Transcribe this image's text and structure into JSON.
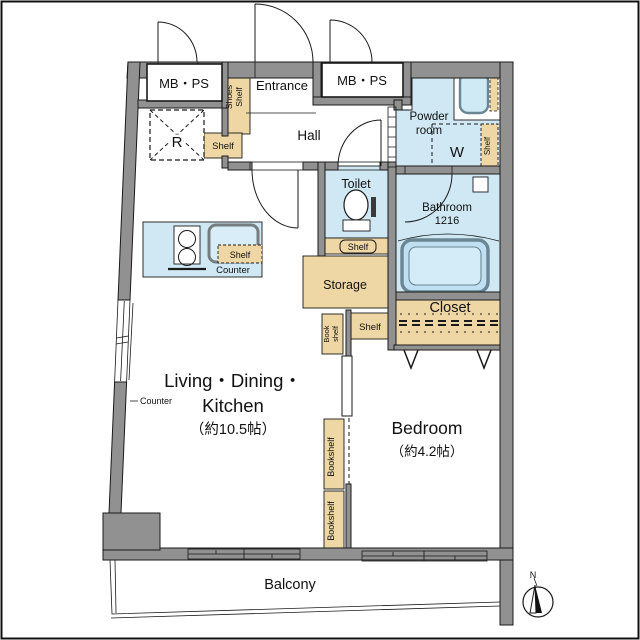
{
  "plan": {
    "rooms": {
      "mbps_left": "MB・PS",
      "mbps_right": "MB・PS",
      "entrance": "Entrance",
      "hall": "Hall",
      "powder_line1": "Powder",
      "powder_line2": "room",
      "toilet": "Toilet",
      "bathroom": "Bathroom",
      "bathroom_size": "1216",
      "washer": "W",
      "storage": "Storage",
      "closet": "Closet",
      "ldk_line1": "Living・Dining・",
      "ldk_line2": "Kitchen",
      "ldk_size": "（約10.5帖）",
      "bedroom": "Bedroom",
      "bedroom_size": "（約4.2帖）",
      "balcony": "Balcony"
    },
    "fixtures": {
      "fridge": "R",
      "shoes_line1": "Shoes",
      "shoes_line2": "Shelf",
      "entry_shelf": "Shelf",
      "kitchen_shelf": "Shelf",
      "kitchen_counter": "Counter",
      "window_counter": "Counter",
      "toilet_shelf": "Shelf",
      "powder_shelf": "Shelf",
      "book_shelf_line1": "Book",
      "book_shelf_line2": "shelf",
      "mid_shelf": "Shelf",
      "bookshelf_upper": "Bookshelf",
      "bookshelf_lower": "Bookshelf"
    },
    "compass": {
      "north": "N"
    },
    "colors": {
      "wall": "#919191",
      "water": "#cfe8f4",
      "wood": "#eed7a4",
      "line": "#1a1a1a"
    }
  }
}
